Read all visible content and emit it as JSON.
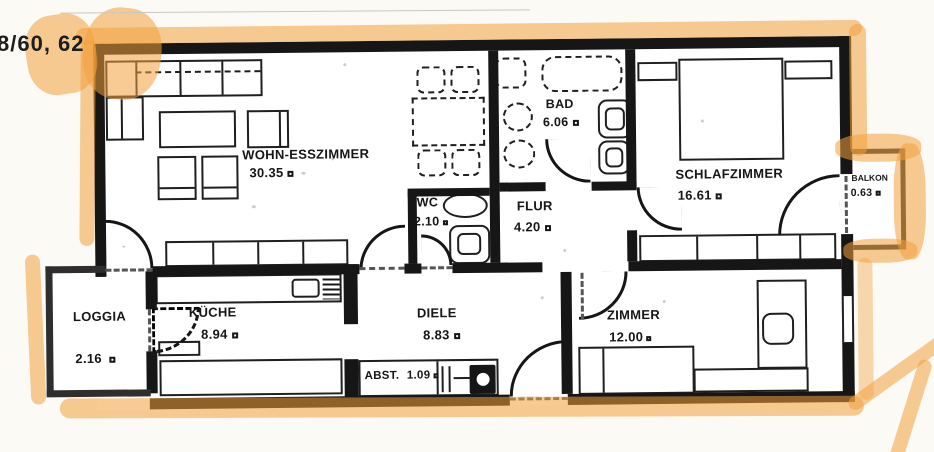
{
  "document": {
    "type": "scanned apartment floor plan with orange highlighter marking",
    "annotation_top_left": "8/60, 62"
  },
  "rooms": [
    {
      "name": "WOHN-ESSZIMMER",
      "area": "30.35"
    },
    {
      "name": "BAD",
      "area": "6.06"
    },
    {
      "name": "SCHLAFZIMMER",
      "area": "16.61"
    },
    {
      "name": "BALKON",
      "area": "0.63"
    },
    {
      "name": "WC",
      "area": "2.10"
    },
    {
      "name": "FLUR",
      "area": "4.20"
    },
    {
      "name": "LOGGIA",
      "area": "2.16"
    },
    {
      "name": "KÜCHE",
      "area": "8.94"
    },
    {
      "name": "DIELE",
      "area": "8.83"
    },
    {
      "name": "ZIMMER",
      "area": "12.00"
    },
    {
      "name": "ABST.",
      "area": "1.09"
    }
  ],
  "colors": {
    "highlighter": "#f2a13d",
    "wall": "#161616",
    "paper": "#fbfaf5"
  }
}
